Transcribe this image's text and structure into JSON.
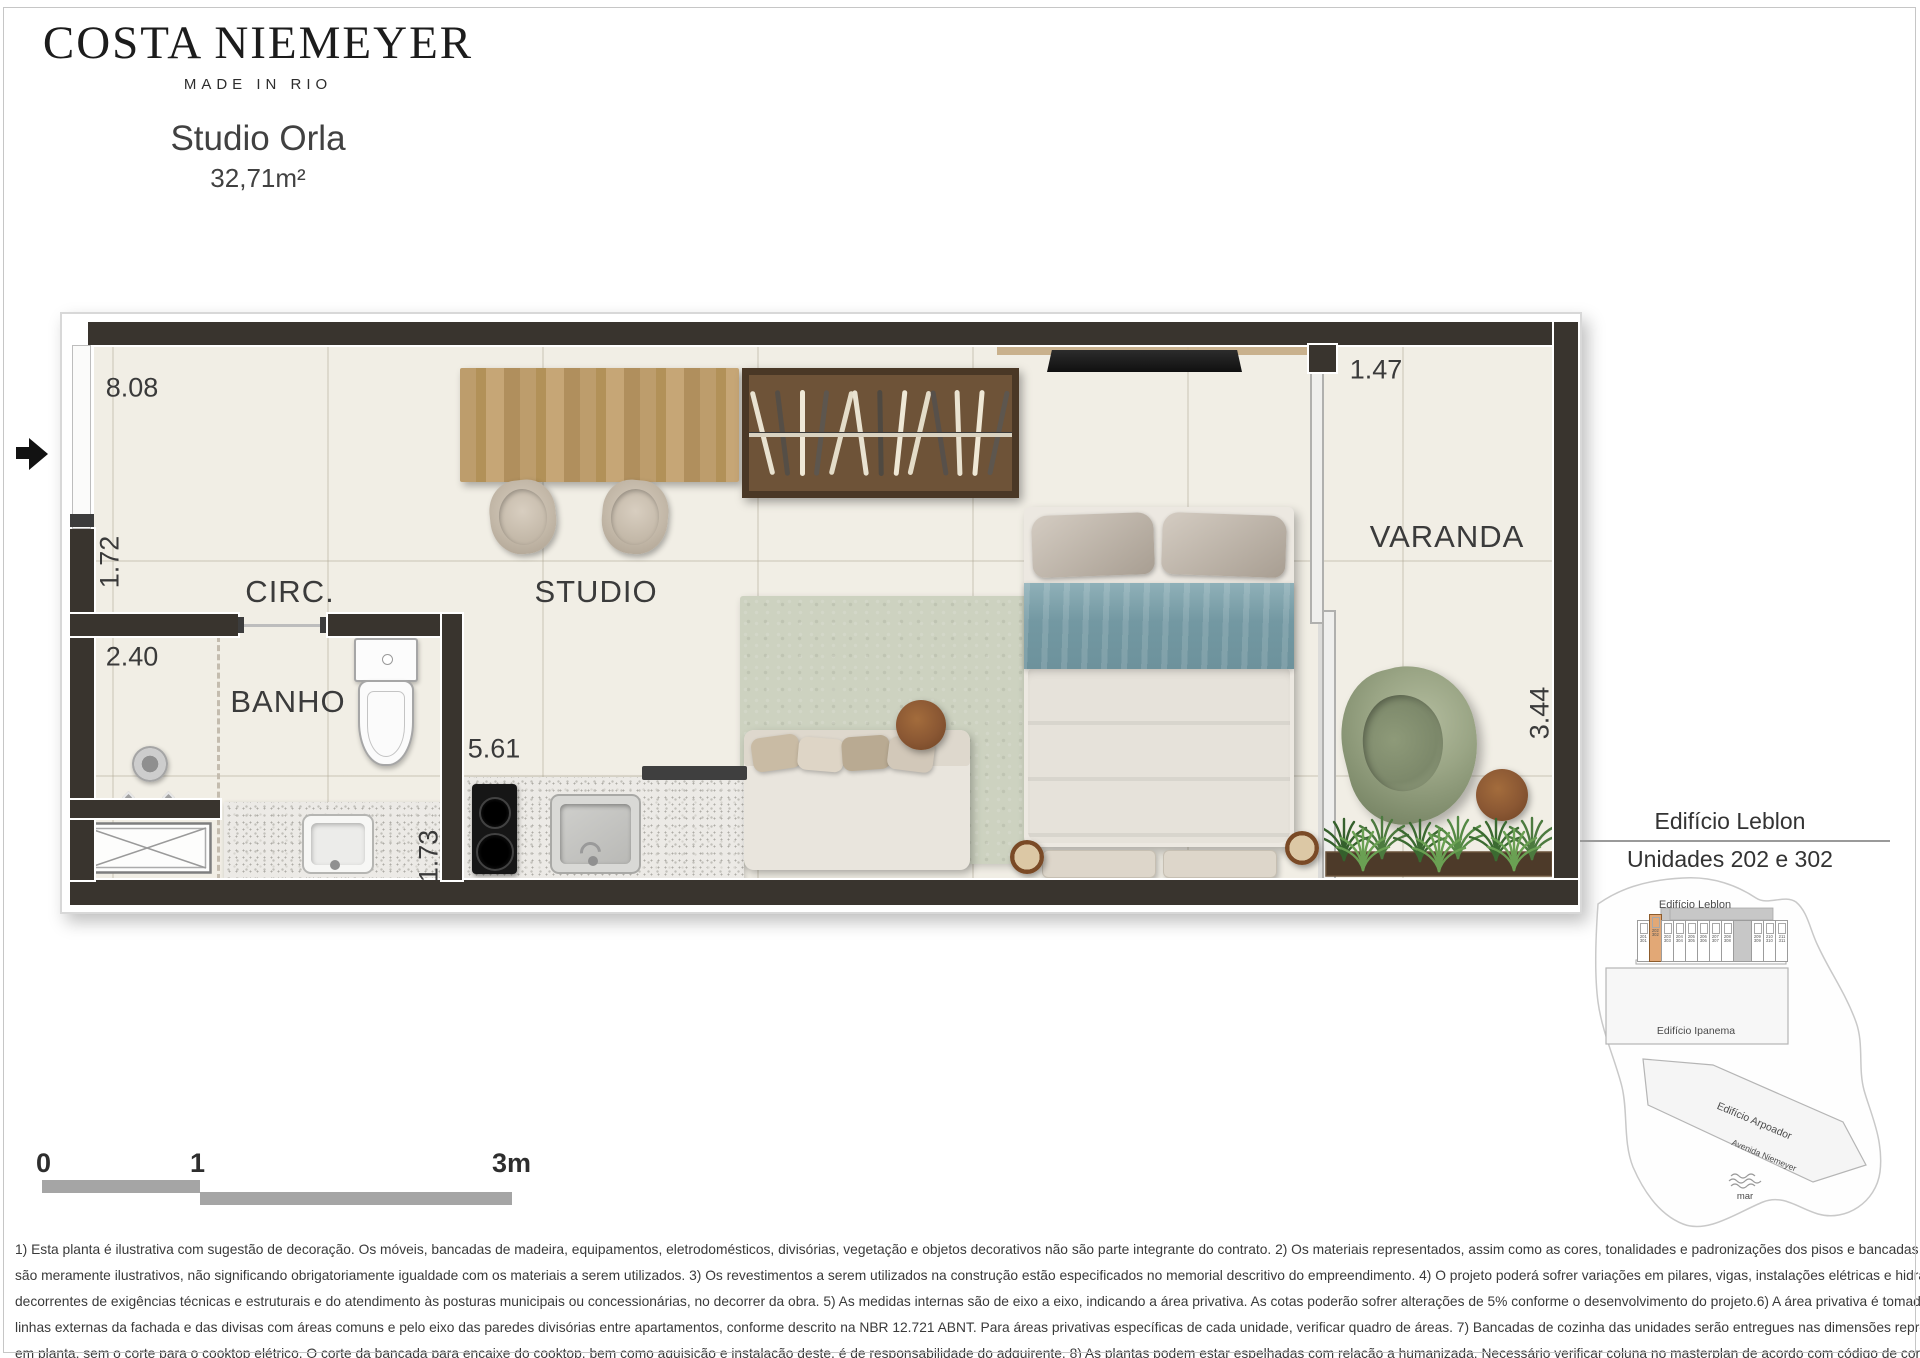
{
  "brand": {
    "name": "COSTA NIEMEYER",
    "tagline": "MADE IN RIO"
  },
  "unit": {
    "name": "Studio Orla",
    "area": "32,71m²"
  },
  "floorplan": {
    "rooms": {
      "circ": "CIRC.",
      "studio": "STUDIO",
      "banho": "BANHO",
      "varanda": "VARANDA"
    },
    "dimensions": {
      "main_width": "8.08",
      "varanda_width": "1.47",
      "circ_height": "1.72",
      "shower_width": "2.40",
      "kitchen_length": "5.61",
      "banho_depth": "1.73",
      "varanda_depth": "3.44"
    }
  },
  "legend": {
    "building": "Edifício Leblon",
    "units": "Unidades 202 e 302"
  },
  "sitemap": {
    "leblon_label": "Edifício Leblon",
    "ipanema_label": "Edifício Ipanema",
    "arpoador_label": "Edifício Arpoador",
    "avenue_label": "Avenida Niemeyer",
    "sea_label": "mar",
    "units_top": [
      "201",
      "202",
      "203",
      "204",
      "205",
      "206",
      "207",
      "208",
      "209",
      "210",
      "211"
    ],
    "units_bottom": [
      "301",
      "302",
      "303",
      "304",
      "305",
      "306",
      "307",
      "308",
      "309",
      "310",
      "311"
    ],
    "highlighted_top": "202",
    "highlighted_bottom": "302",
    "highlight_color": "#e2a876"
  },
  "scalebar": {
    "t0": "0",
    "t1": "1",
    "t3": "3m"
  },
  "disclaimer": {
    "lines": [
      "1) Esta planta é ilustrativa com sugestão de decoração. Os móveis, bancadas de madeira, equipamentos, eletrodomésticos, divisórias, vegetação e objetos decorativos não são parte integrante do contrato.  2) Os  materiais  representados, assim  como  as  cores, tonalidades  e  padronizações  dos  pisos  e  bancadas",
      "são meramente ilustrativos, não significando obrigatoriamente igualdade com os materiais  a serem  utilizados. 3) Os revestimentos a serem utilizados na construção estão especificados no memorial descritivo do empreendimento. 4) O projeto poderá sofrer variações em pilares, vigas, instalações elétricas e hidráulicas,",
      "decorrentes de exigências técnicas e estruturais e do atendimento às posturas municipais ou concessionárias, no decorrer da obra. 5) As medidas internas são de eixo a eixo, indicando a área privativa. As cotas poderão sofrer alterações de 5% conforme  o desenvolvimento do projeto.6) A área privativa é tomada pelas",
      "linhas externas da fachada e das divisas com áreas comuns e pelo eixo das paredes divisórias entre apartamentos, conforme descrito na NBR 12.721 ABNT. Para áreas privativas específicas de cada  unidade, verificar quadro de áreas. 7) Bancadas de cozinha das unidades serão entregues nas dimensões representadas",
      "em planta, sem o corte para o cooktop elétrico.  O corte da bancada para encaixe do cooktop, bem como aquisição e instalação deste, é de responsabilidade do adquirente. 8) As plantas podem estar espelhadas com relação a humanizada. Necessário verificar coluna no masterplan de acordo com código de cores."
    ]
  },
  "colors": {
    "wall": "#39342e",
    "floor": "#f1eee5",
    "wood": "#b2926a",
    "rug": "#cdd2c0",
    "bed_blue": "#7c9fa8",
    "chair_green": "#99a386",
    "highlight_unit": "#e2a876"
  }
}
